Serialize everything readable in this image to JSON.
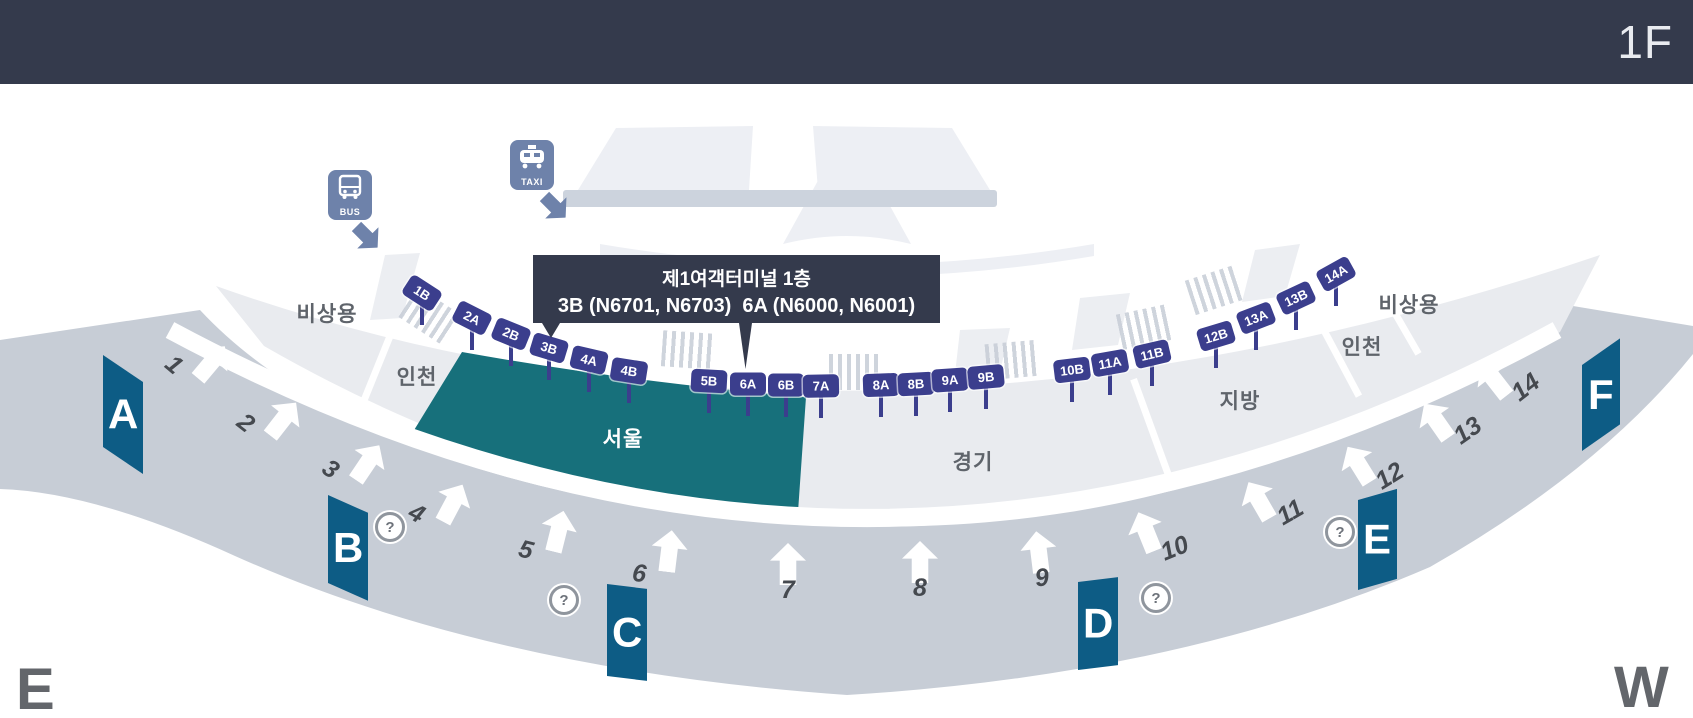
{
  "header": {
    "floor_label": "1F"
  },
  "compass": {
    "east": "E",
    "west": "W"
  },
  "tooltip": {
    "line1": "제1여객터미널 1층",
    "line2": "3B (N6701, N6703)  6A (N6000, N6001)"
  },
  "transport": {
    "bus_label": "BUS",
    "taxi_label": "TAXI"
  },
  "map": {
    "title_context": "제1여객터미널 1층",
    "gates": [
      {
        "label": "1B"
      },
      {
        "label": "2A"
      },
      {
        "label": "2B"
      },
      {
        "label": "3B"
      },
      {
        "label": "4A"
      },
      {
        "label": "4B"
      },
      {
        "label": "5B"
      },
      {
        "label": "6A"
      },
      {
        "label": "6B"
      },
      {
        "label": "7A"
      },
      {
        "label": "8A"
      },
      {
        "label": "8B"
      },
      {
        "label": "9A"
      },
      {
        "label": "9B"
      },
      {
        "label": "10B"
      },
      {
        "label": "11A"
      },
      {
        "label": "11B"
      },
      {
        "label": "12B"
      },
      {
        "label": "13A"
      },
      {
        "label": "13B"
      },
      {
        "label": "14A"
      }
    ],
    "road_stops": [
      {
        "label": "1"
      },
      {
        "label": "2"
      },
      {
        "label": "3"
      },
      {
        "label": "4"
      },
      {
        "label": "5"
      },
      {
        "label": "6"
      },
      {
        "label": "7"
      },
      {
        "label": "8"
      },
      {
        "label": "9"
      },
      {
        "label": "10"
      },
      {
        "label": "11"
      },
      {
        "label": "12"
      },
      {
        "label": "13"
      },
      {
        "label": "14"
      }
    ],
    "zone_markers": [
      {
        "label": "A"
      },
      {
        "label": "B"
      },
      {
        "label": "C"
      },
      {
        "label": "D"
      },
      {
        "label": "E"
      },
      {
        "label": "F"
      }
    ],
    "regions": [
      {
        "label": "비상용"
      },
      {
        "label": "인천"
      },
      {
        "label": "서울"
      },
      {
        "label": "경기"
      },
      {
        "label": "지방"
      },
      {
        "label": "인천"
      },
      {
        "label": "비상용"
      }
    ],
    "help_icon_symbol": "?",
    "colors": {
      "header_bg": "#343a4c",
      "road": "#c7cdd6",
      "platform": "#e9ebef",
      "teal": "#17707b",
      "marker_blue": "#0d5c85",
      "gate_navy": "#3b3e8d",
      "icon_blue": "#6e82aa",
      "label_gray": "#5f646b",
      "number_gray": "#45494f",
      "compass_gray": "#63666b",
      "tooltip_bg": "#343a4c"
    }
  }
}
